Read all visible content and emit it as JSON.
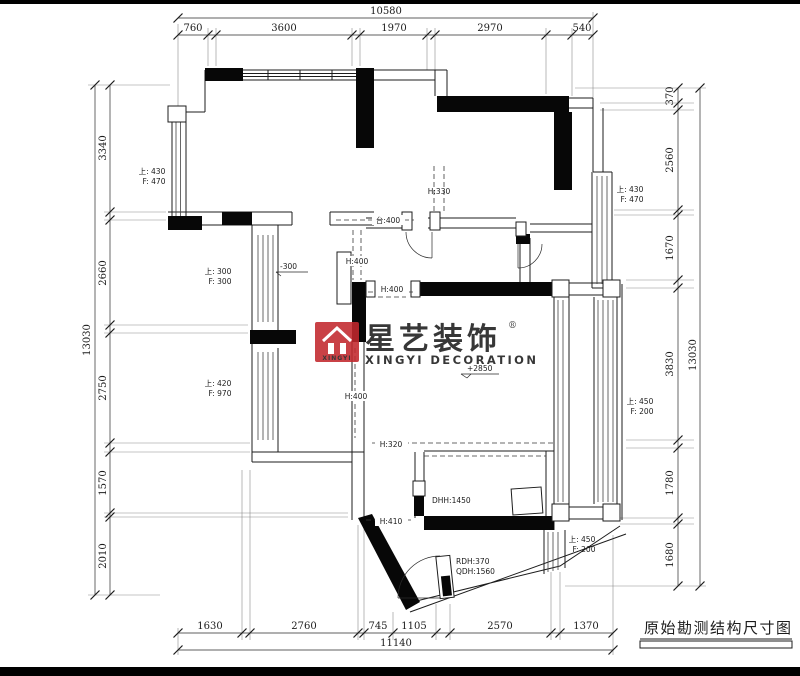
{
  "title": "原始勘测结构尺寸图",
  "logo": {
    "cn": "星艺装饰",
    "en": "XINGYI DECORATION",
    "badge": "XINGYI",
    "reg": "®",
    "red": "#c2272d",
    "gray": "#9e9e9e"
  },
  "dims": {
    "top": {
      "total": "10580",
      "segs": [
        "760",
        "3600",
        "1970",
        "2970",
        "540"
      ]
    },
    "bottom": {
      "total": "11140",
      "segs": [
        "1630",
        "2760",
        "745",
        "1105",
        "2570",
        "1370"
      ]
    },
    "left": {
      "total": "13030",
      "segs": [
        "3340",
        "2660",
        "2750",
        "1570",
        "2010"
      ]
    },
    "right": {
      "total": "13030",
      "segs": [
        "370",
        "2560",
        "1670",
        "3830",
        "1780",
        "1680"
      ]
    }
  },
  "windows": {
    "left_top": {
      "l1": "上: 430",
      "l2": "F: 470"
    },
    "left_mid": {
      "l1": "上: 300",
      "l2": "F: 300"
    },
    "left_low": {
      "l1": "上: 420",
      "l2": "F: 970"
    },
    "right_top": {
      "l1": "上: 430",
      "l2": "F: 470"
    },
    "right_mid": {
      "l1": "上: 450",
      "l2": "F: 200"
    },
    "right_low": {
      "l1": "上: 450",
      "l2": "F: 200"
    }
  },
  "beams": {
    "h330": "H:330",
    "t400": "台:400",
    "h400a": "H:400",
    "h400b": "H:400",
    "h400c": "H:400",
    "h320": "H:320",
    "h410": "H:410"
  },
  "doors": {
    "dhh": "DHH:1450",
    "rdh": "RDH:370",
    "qdh": "QDH:1560"
  },
  "levels": {
    "minus": "-300",
    "plus": "+2850"
  }
}
